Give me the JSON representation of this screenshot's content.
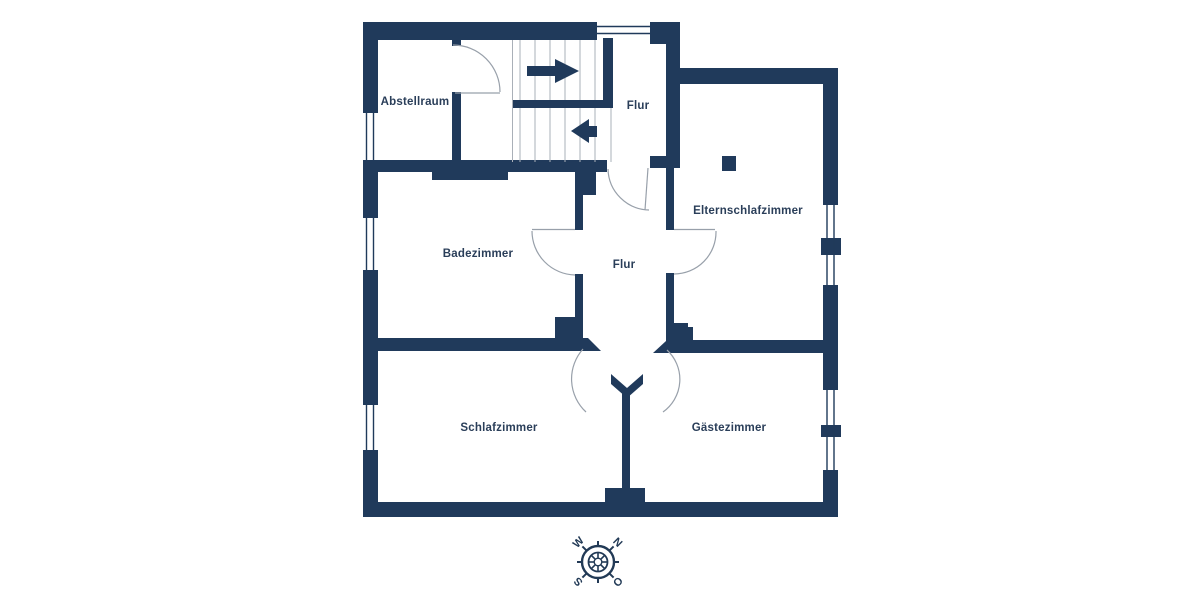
{
  "plan": {
    "type": "floor-plan",
    "language": "de",
    "rooms": [
      {
        "id": "abstellraum",
        "label": "Abstellraum"
      },
      {
        "id": "flur-top",
        "label": "Flur"
      },
      {
        "id": "elternschlafzimmer",
        "label": "Elternschlafzimmer"
      },
      {
        "id": "badezimmer",
        "label": "Badezimmer"
      },
      {
        "id": "flur-center",
        "label": "Flur"
      },
      {
        "id": "schlafzimmer",
        "label": "Schlafzimmer"
      },
      {
        "id": "gaestezimmer",
        "label": "Gästezimmer"
      }
    ],
    "features": [
      "staircase-with-up-down-arrows",
      "door-swing-arcs",
      "double-line-windows",
      "chimney-block",
      "double-swing-door-hall"
    ],
    "compass": {
      "north": "N",
      "east": "O",
      "south": "S",
      "west": "W"
    },
    "palette": {
      "wall": "#203a5b",
      "label_text": "#2a3e59",
      "door_arc": "#98a0aa",
      "stair_tread": "#aab0b8",
      "background": "#ffffff"
    }
  }
}
